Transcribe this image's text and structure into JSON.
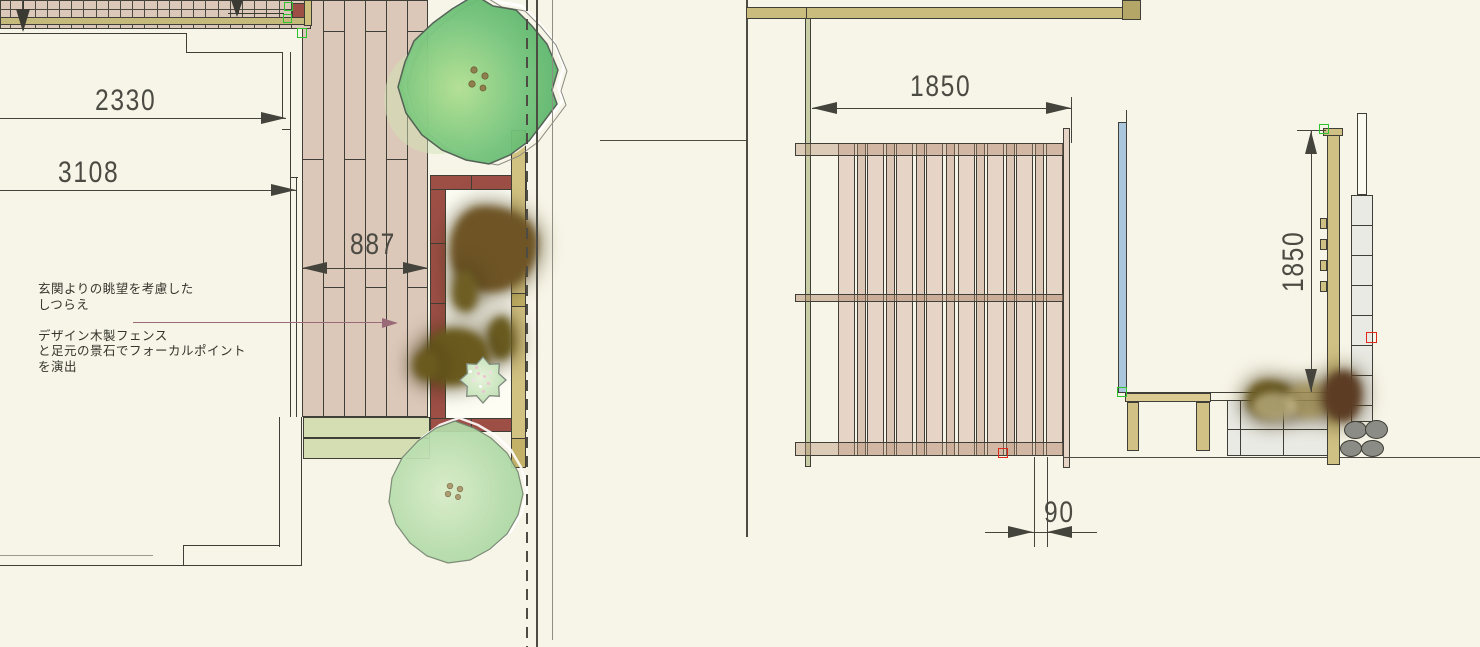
{
  "drawing": {
    "type": "garden-plan-and-elevation",
    "annotation": {
      "line1": "玄関よりの眺望を考慮した",
      "line2": "しつらえ",
      "line3": "デザイン木製フェンス",
      "line4": "と足元の景石でフォーカルポイント",
      "line5": "を演出"
    },
    "dimensions": {
      "approach_width": "2330",
      "approach_depth": "3108",
      "deck_width": "887",
      "fence_width": "1850",
      "slat_module": "90",
      "fence_height": "1850"
    },
    "colors": {
      "background": "#f7f5e7",
      "deck_wood": "#dcc8b9",
      "fence_plan_red": "#9d4f46",
      "screen_tan": "#d2c282",
      "joist_khaki": "#c6b97c",
      "tree_green": "#5cb46c",
      "tree_pale_green": "#a6d6a0",
      "slat_wood": "#e6d4c6",
      "post_khaki": "#cfc083",
      "panel_blue": "#abc7dd",
      "tile_gray": "#eaeae4",
      "pebble_gray": "#8c8c86",
      "leader_mauve": "#9a6a78",
      "handle_green": "#2ec22e",
      "handle_red": "#e02818",
      "line_dark": "#3f3f37"
    }
  },
  "geometry": {
    "rects": [
      {
        "n": "deck",
        "x": 302,
        "y": 0,
        "w": 126,
        "h": 417,
        "c": "#dcc8b9",
        "b": 2
      },
      {
        "n": "deck-plank-seam",
        "xs": [
          323,
          344,
          365,
          386,
          407
        ],
        "y": 0,
        "w": 1.2,
        "h": 417,
        "c": "#3f3f37"
      },
      {
        "n": "deck-joint",
        "xs": [
          323,
          365,
          407
        ],
        "y": 31,
        "w": 21,
        "h": 1.2,
        "c": "#3f3f37"
      },
      {
        "n": "deck-joint",
        "xs": [
          302,
          344,
          386
        ],
        "y": 159,
        "w": 21,
        "h": 1.2,
        "c": "#3f3f37"
      },
      {
        "n": "deck-joint",
        "xs": [
          323,
          365,
          407
        ],
        "y": 287,
        "w": 21,
        "h": 1.2,
        "c": "#3f3f37"
      },
      {
        "n": "planter-strip",
        "x": 303,
        "ys": [
          417,
          438
        ],
        "w": 127,
        "h": 21,
        "c": "#d4deb2",
        "b": 1
      },
      {
        "n": "walkway",
        "x": 0,
        "y": 0,
        "w": 311,
        "h": 29,
        "c": "#dcc8b9",
        "b": 1
      },
      {
        "n": "walkway-board-seam",
        "xs": [
          10,
          22,
          35,
          47,
          59,
          71,
          83,
          96,
          108,
          120,
          132,
          144,
          157,
          169,
          181,
          193,
          205,
          218,
          230,
          242,
          254,
          266,
          279,
          291
        ],
        "y": 0,
        "w": 1,
        "h": 28,
        "c": "#4a4a42"
      },
      {
        "n": "walkway-mid-seam",
        "x": 0,
        "y": 9,
        "w": 311,
        "h": 1,
        "c": "#4a4a42"
      },
      {
        "n": "walkway-joist",
        "x": 0,
        "y": 17,
        "w": 311,
        "h": 8,
        "c": "#c6b97c",
        "b": 1
      },
      {
        "n": "walkway-end-block",
        "x": 292,
        "y": 3,
        "w": 13,
        "h": 15,
        "c": "#9d4f46",
        "b": 1
      },
      {
        "n": "walkway-end-post",
        "x": 304,
        "y": 0,
        "w": 8,
        "h": 26,
        "c": "#cdbf7e",
        "b": 1
      },
      {
        "n": "dim-arrow-line",
        "x": 23,
        "y": 0,
        "w": 1.4,
        "h": 30,
        "c": "#3a3a32",
        "cls": "z3"
      },
      {
        "n": "down-arrow",
        "x": 16,
        "y": 9,
        "cls": "td-big"
      },
      {
        "n": "dim-arrow-line",
        "x": 238,
        "y": 0,
        "w": 1.4,
        "h": 13,
        "c": "#3a3a32",
        "cls": "z3"
      },
      {
        "n": "dim-line",
        "x": 228,
        "y": 13,
        "w": 56,
        "h": 1,
        "c": "#3a3a32",
        "cls": "z3"
      },
      {
        "n": "down-arrow",
        "x": 231,
        "y": 0,
        "cls": "td-sm"
      },
      {
        "n": "house-line",
        "x": 0,
        "y": 33,
        "w": 187,
        "h": 1.4,
        "c": "#3f3f37"
      },
      {
        "n": "house-line",
        "x": 186,
        "y": 33,
        "w": 1.4,
        "h": 20,
        "c": "#3f3f37"
      },
      {
        "n": "house-line",
        "x": 186,
        "y": 52,
        "w": 97,
        "h": 1.4,
        "c": "#3f3f37"
      },
      {
        "n": "house-line",
        "x": 282,
        "y": 52,
        "w": 1.4,
        "h": 66,
        "c": "#3f3f37"
      },
      {
        "n": "house-line",
        "x": 290,
        "y": 52,
        "w": 1.4,
        "h": 365,
        "c": "#3f3f37"
      },
      {
        "n": "house-tick",
        "x": 282,
        "y": 129,
        "w": 9,
        "h": 1,
        "c": "#3f3f37"
      },
      {
        "n": "house-tick",
        "x": 290,
        "y": 177,
        "w": 8,
        "h": 1.4,
        "c": "#3f3f37"
      },
      {
        "n": "house-line",
        "x": 296,
        "y": 177,
        "w": 1.4,
        "h": 240,
        "c": "#3f3f37"
      },
      {
        "n": "house-line",
        "x": 279,
        "y": 417,
        "w": 1.4,
        "h": 130,
        "c": "#3f3f37"
      },
      {
        "n": "house-line",
        "x": 183,
        "y": 545,
        "w": 97,
        "h": 1.4,
        "c": "#3f3f37"
      },
      {
        "n": "house-line",
        "x": 183,
        "y": 545,
        "w": 1.4,
        "h": 21,
        "c": "#3f3f37"
      },
      {
        "n": "house-line",
        "x": 0,
        "y": 565,
        "w": 302,
        "h": 1.4,
        "c": "#3f3f37"
      },
      {
        "n": "house-line",
        "x": 301,
        "y": 417,
        "w": 1.4,
        "h": 149,
        "c": "#3f3f37"
      },
      {
        "n": "eave-line",
        "x": 0,
        "y": 555,
        "w": 153,
        "h": 1,
        "c": "#9a9a90"
      },
      {
        "n": "dim-line",
        "x": 0,
        "y": 118,
        "w": 286,
        "h": 1.2,
        "c": "#44443c",
        "cls": "z3"
      },
      {
        "n": "dim-arrow",
        "x": 261,
        "y": 112,
        "cls": "tr"
      },
      {
        "n": "dim-line",
        "x": 0,
        "y": 190,
        "w": 296,
        "h": 1.2,
        "c": "#44443c",
        "cls": "z3"
      },
      {
        "n": "dim-arrow",
        "x": 271,
        "y": 184,
        "cls": "tr"
      },
      {
        "n": "dim-line",
        "x": 302,
        "y": 268,
        "w": 126,
        "h": 1.2,
        "c": "#44443c",
        "cls": "z3"
      },
      {
        "n": "dim-arrow",
        "x": 302,
        "y": 262,
        "cls": "tl"
      },
      {
        "n": "dim-arrow",
        "x": 403,
        "y": 262,
        "cls": "tr"
      },
      {
        "n": "garden-bed",
        "x": 446,
        "y": 190,
        "w": 65,
        "h": 228,
        "c": "#fdfdf4"
      },
      {
        "n": "fence-plan-left",
        "x": 430,
        "y": 175,
        "w": 16,
        "h": 257,
        "c": "#9d4f46",
        "b": 2
      },
      {
        "n": "fence-plan-seam",
        "x": 430,
        "ys": [
          243,
          303
        ],
        "w": 16,
        "h": 1.2,
        "c": "#3f3f37"
      },
      {
        "n": "fence-plan-top",
        "x": 430,
        "y": 175,
        "w": 83,
        "h": 15,
        "c": "#9d4f46",
        "b": 2
      },
      {
        "n": "fence-plan-seam",
        "x": 471,
        "y": 175,
        "w": 1.2,
        "h": 15,
        "c": "#3f3f37"
      },
      {
        "n": "fence-plan-bottom",
        "x": 430,
        "y": 418,
        "w": 83,
        "h": 14,
        "c": "#9d4f46",
        "b": 2
      },
      {
        "n": "fence-plan-seam",
        "x": 471,
        "y": 418,
        "w": 1.2,
        "h": 14,
        "c": "#3f3f37"
      },
      {
        "n": "fence-plan-block",
        "x": 513,
        "y": 175,
        "w": 14,
        "h": 15,
        "c": "#c4b46e",
        "b": 1
      },
      {
        "n": "fence-plan-block",
        "x": 513,
        "y": 418,
        "w": 14,
        "h": 14,
        "c": "#c4b46e",
        "b": 1
      },
      {
        "n": "screen-plan",
        "x": 511,
        "y": 130,
        "w": 15,
        "h": 338,
        "c": "#d2c282",
        "b": 2
      },
      {
        "n": "screen-plan-block",
        "x": 511,
        "y": 293,
        "w": 15,
        "h": 14,
        "c": "#c2b166",
        "b": 1
      },
      {
        "n": "screen-plan-block",
        "x": 511,
        "y": 438,
        "w": 15,
        "h": 30,
        "c": "#c2b166",
        "b": 1
      },
      {
        "n": "stone",
        "x": 450,
        "y": 206,
        "w": 88,
        "h": 86,
        "c": "#6f5526",
        "cls": "stone",
        "br": "38% 62% 55% 45%/52% 44% 60% 48%"
      },
      {
        "n": "stone",
        "x": 452,
        "y": 270,
        "w": 26,
        "h": 42,
        "c": "#6e5e24",
        "cls": "stone",
        "br": "50% 50% 45% 55%/60% 55% 45% 40%"
      },
      {
        "n": "stone",
        "x": 487,
        "y": 316,
        "w": 28,
        "h": 44,
        "c": "#6a5c20",
        "cls": "stone",
        "br": "55% 45% 50% 50%/45% 60% 40% 55%"
      },
      {
        "n": "stone",
        "x": 424,
        "y": 328,
        "w": 66,
        "h": 58,
        "c": "#6a5a1e",
        "cls": "stone",
        "br": "45% 55% 60% 40%/50% 48% 55% 45%"
      },
      {
        "n": "stone",
        "x": 413,
        "y": 350,
        "w": 27,
        "h": 30,
        "c": "#6a5a1e",
        "cls": "stone",
        "br": "50% 50% 50% 50%/55% 45% 50% 50%"
      },
      {
        "n": "boundary-dashed",
        "x": 526,
        "y": 0,
        "h": 647,
        "cls": "vdash"
      },
      {
        "n": "boundary-line",
        "x": 536,
        "y": 0,
        "w": 1.5,
        "h": 647,
        "c": "#4c4c44",
        "cls": "z3"
      },
      {
        "n": "boundary-line2",
        "x": 552,
        "y": 0,
        "w": 1.2,
        "h": 640,
        "c": "#8e8e84",
        "cls": "z3"
      },
      {
        "n": "ground-link-line",
        "x": 600,
        "y": 140,
        "w": 147,
        "h": 1.2,
        "c": "#4c4c44"
      },
      {
        "n": "section-border",
        "x": 746,
        "y": 0,
        "w": 1.5,
        "h": 537,
        "c": "#4c4c44"
      },
      {
        "n": "header-band",
        "x": 746,
        "y": 7,
        "w": 395,
        "h": 12,
        "c": "#c9bc7d",
        "b": 1
      },
      {
        "n": "header-band-seam",
        "x": 806,
        "y": 7,
        "w": 1,
        "h": 12,
        "c": "#3f3f37"
      },
      {
        "n": "header-band-block",
        "x": 1122,
        "y": 0,
        "w": 19,
        "h": 20,
        "c": "#b3a666",
        "b": 1
      },
      {
        "n": "fence-post-left",
        "x": 805,
        "y": 18,
        "w": 6,
        "h": 449,
        "c": "#c9cda6",
        "b": 1
      },
      {
        "n": "fence-slat",
        "xs": [
          838,
          867,
          896,
          926,
          958,
          987,
          1016,
          1046
        ],
        "y": 143,
        "w": 17,
        "h": 313,
        "c": "#e6d4c6",
        "b": 1
      },
      {
        "n": "fence-slat-narrow",
        "xs": [
          857,
          886,
          916,
          946,
          976,
          1006,
          1035
        ],
        "y": 143,
        "w": 9,
        "h": 313,
        "c": "#dcc6b6",
        "b": 1
      },
      {
        "n": "fence-rail-top",
        "x": 795,
        "y": 143,
        "w": 270,
        "h": 13,
        "c": "rgba(180,140,112,.40)",
        "b": 1
      },
      {
        "n": "fence-rail-mid",
        "x": 795,
        "y": 294,
        "w": 270,
        "h": 8,
        "c": "rgba(170,128,100,.45)",
        "b": 1
      },
      {
        "n": "fence-rail-bottom",
        "x": 795,
        "y": 442,
        "w": 270,
        "h": 14,
        "c": "rgba(180,140,112,.40)",
        "b": 1
      },
      {
        "n": "fence-post-right",
        "x": 1063,
        "y": 128,
        "w": 7,
        "h": 340,
        "c": "#e6d4c6",
        "b": 1
      },
      {
        "n": "ground-line",
        "x": 1063,
        "y": 457,
        "w": 417,
        "h": 1.3,
        "c": "#4c4c44"
      },
      {
        "n": "dim-line",
        "x": 812,
        "y": 108,
        "w": 259,
        "h": 1.2,
        "c": "#44443c",
        "cls": "z3"
      },
      {
        "n": "dim-arrow",
        "x": 812,
        "y": 102,
        "cls": "tl"
      },
      {
        "n": "dim-arrow",
        "x": 1046,
        "y": 102,
        "cls": "tr"
      },
      {
        "n": "dim-ext",
        "x": 1071,
        "y": 97,
        "w": 1,
        "h": 46,
        "c": "#44443c",
        "cls": "z3"
      },
      {
        "n": "dim-ext",
        "xs": [
          1034,
          1047
        ],
        "y": 457,
        "w": 1,
        "h": 90,
        "c": "#44443c",
        "cls": "z3"
      },
      {
        "n": "dim-line",
        "x": 985,
        "y": 532,
        "w": 112,
        "h": 1.2,
        "c": "#44443c",
        "cls": "z3"
      },
      {
        "n": "dim-arrow",
        "x": 1008,
        "y": 526,
        "cls": "tr"
      },
      {
        "n": "dim-arrow",
        "x": 1047,
        "y": 526,
        "cls": "tl"
      },
      {
        "n": "screen-panel",
        "x": 1118,
        "y": 122,
        "w": 9,
        "h": 271,
        "c": "#abc7dd",
        "b": 1
      },
      {
        "n": "screen-panel-line",
        "x": 1126,
        "y": 110,
        "w": 1.2,
        "h": 12,
        "c": "#3f3f37"
      },
      {
        "n": "datum-line",
        "x": 1126,
        "y": 392,
        "w": 202,
        "h": 1.2,
        "c": "#3f3f37"
      },
      {
        "n": "datum-line2",
        "x": 1210,
        "y": 400,
        "w": 17,
        "h": 1,
        "c": "#3f3f37"
      },
      {
        "n": "bench-top",
        "x": 1125,
        "y": 393,
        "w": 86,
        "h": 9,
        "c": "#dbcb92",
        "b": 1
      },
      {
        "n": "bench-leg",
        "x": 1127,
        "y": 402,
        "w": 12,
        "h": 49,
        "c": "#d2c185",
        "b": 1
      },
      {
        "n": "bench-leg",
        "x": 1196,
        "y": 402,
        "w": 14,
        "h": 49,
        "c": "#d2c185",
        "b": 1
      },
      {
        "n": "planter-box",
        "x": 1227,
        "y": 400,
        "w": 113,
        "h": 56,
        "c": "#eaeae4",
        "b": 2
      },
      {
        "n": "planter-seam",
        "xs": [
          1240,
          1283
        ],
        "y": 400,
        "w": 1.1,
        "h": 56,
        "c": "#3f3f37"
      },
      {
        "n": "planter-seam-h",
        "x": 1227,
        "y": 429,
        "w": 113,
        "h": 1.1,
        "c": "#3f3f37"
      },
      {
        "n": "pillar-column",
        "x": 1351,
        "y": 195,
        "w": 22,
        "h": 227,
        "c": "#eaeae4",
        "b": 2
      },
      {
        "n": "pillar-seam",
        "x": 1351,
        "ys": [
          225,
          255,
          285,
          315,
          345,
          375,
          405
        ],
        "w": 22,
        "h": 1.1,
        "c": "#3f3f37"
      },
      {
        "n": "pillar-cap",
        "x": 1357,
        "y": 113,
        "w": 10,
        "h": 82,
        "c": "#fcfbf2",
        "b": 1
      },
      {
        "n": "post-cap",
        "x": 1323,
        "y": 128,
        "w": 20,
        "h": 8,
        "c": "#cfc083",
        "b": 1
      },
      {
        "n": "center-post",
        "x": 1327,
        "y": 135,
        "w": 13,
        "h": 330,
        "c": "#cfc083",
        "b": 2
      },
      {
        "n": "post-bracket",
        "x": 1320,
        "ys": [
          218,
          239,
          260,
          281
        ],
        "w": 7,
        "h": 11,
        "c": "#cfc083",
        "b": 1
      },
      {
        "n": "stone",
        "x": 1246,
        "y": 380,
        "w": 48,
        "h": 38,
        "c": "#6e5e24",
        "cls": "stone",
        "br": "45% 55% 50% 50%/55% 50% 45% 50%"
      },
      {
        "n": "stone",
        "x": 1286,
        "y": 383,
        "w": 48,
        "h": 35,
        "c": "#a6945a",
        "cls": "stone",
        "o": 0.85,
        "br": "50% 50% 55% 45%/45% 55% 50% 50%"
      },
      {
        "n": "stone",
        "x": 1322,
        "y": 370,
        "w": 40,
        "h": 52,
        "c": "#5c3d24",
        "cls": "stone",
        "br": "55% 45% 45% 55%/50% 45% 55% 50%"
      },
      {
        "n": "stone",
        "x": 1252,
        "y": 392,
        "w": 45,
        "h": 28,
        "c": "#cfc49a",
        "cls": "stone",
        "o": 0.6,
        "br": "50%"
      },
      {
        "n": "pebble",
        "x": 1344,
        "y": 421,
        "w": 23,
        "h": 18,
        "c": "#8c8c86",
        "b": 1,
        "br": "50%",
        "cls": "z3"
      },
      {
        "n": "pebble",
        "x": 1365,
        "y": 420,
        "w": 23,
        "h": 19,
        "c": "#8c8c86",
        "b": 1,
        "br": "50%",
        "cls": "z3"
      },
      {
        "n": "pebble",
        "x": 1340,
        "y": 440,
        "w": 22,
        "h": 17,
        "c": "#8c8c86",
        "b": 1,
        "br": "50%",
        "cls": "z3"
      },
      {
        "n": "pebble",
        "x": 1361,
        "y": 440,
        "w": 23,
        "h": 17,
        "c": "#8c8c86",
        "b": 1,
        "br": "50%",
        "cls": "z3"
      },
      {
        "n": "dim-ext",
        "x": 1297,
        "y": 130,
        "w": 29,
        "h": 1,
        "c": "#44443c",
        "cls": "z3"
      },
      {
        "n": "dim-line",
        "x": 1311,
        "y": 131,
        "w": 1.2,
        "h": 261,
        "c": "#44443c",
        "cls": "z3"
      },
      {
        "n": "dim-arrow",
        "x": 1305,
        "y": 131,
        "cls": "tu"
      },
      {
        "n": "dim-arrow",
        "x": 1305,
        "y": 369,
        "cls": "td"
      },
      {
        "n": "leader-line",
        "x": 133,
        "y": 322,
        "w": 254,
        "h": 1.3,
        "c": "#9a6a78",
        "cls": "z3"
      },
      {
        "n": "leader-arrow",
        "x": 382,
        "y": 318,
        "cls": "trm"
      },
      {
        "n": "handle-green",
        "x": 284,
        "y": 2,
        "w": 9,
        "h": 9,
        "cls": "hgreen",
        "i": 1
      },
      {
        "n": "handle-green",
        "x": 283,
        "y": 14,
        "w": 9,
        "h": 9,
        "cls": "hgreen",
        "i": 1
      },
      {
        "n": "handle-green",
        "x": 297,
        "y": 28,
        "w": 10,
        "h": 10,
        "cls": "hgreen",
        "i": 1
      },
      {
        "n": "handle-green",
        "x": 1319,
        "y": 124,
        "w": 10,
        "h": 10,
        "cls": "hgreen",
        "i": 1
      },
      {
        "n": "handle-green",
        "x": 1117,
        "y": 387,
        "w": 10,
        "h": 10,
        "cls": "hgreen",
        "i": 1
      },
      {
        "n": "handle-red",
        "x": 998,
        "y": 448,
        "w": 10,
        "h": 10,
        "cls": "hred",
        "i": 1
      },
      {
        "n": "handle-red",
        "x": 1366,
        "y": 332,
        "w": 11,
        "h": 11,
        "cls": "hred",
        "i": 1
      }
    ]
  }
}
